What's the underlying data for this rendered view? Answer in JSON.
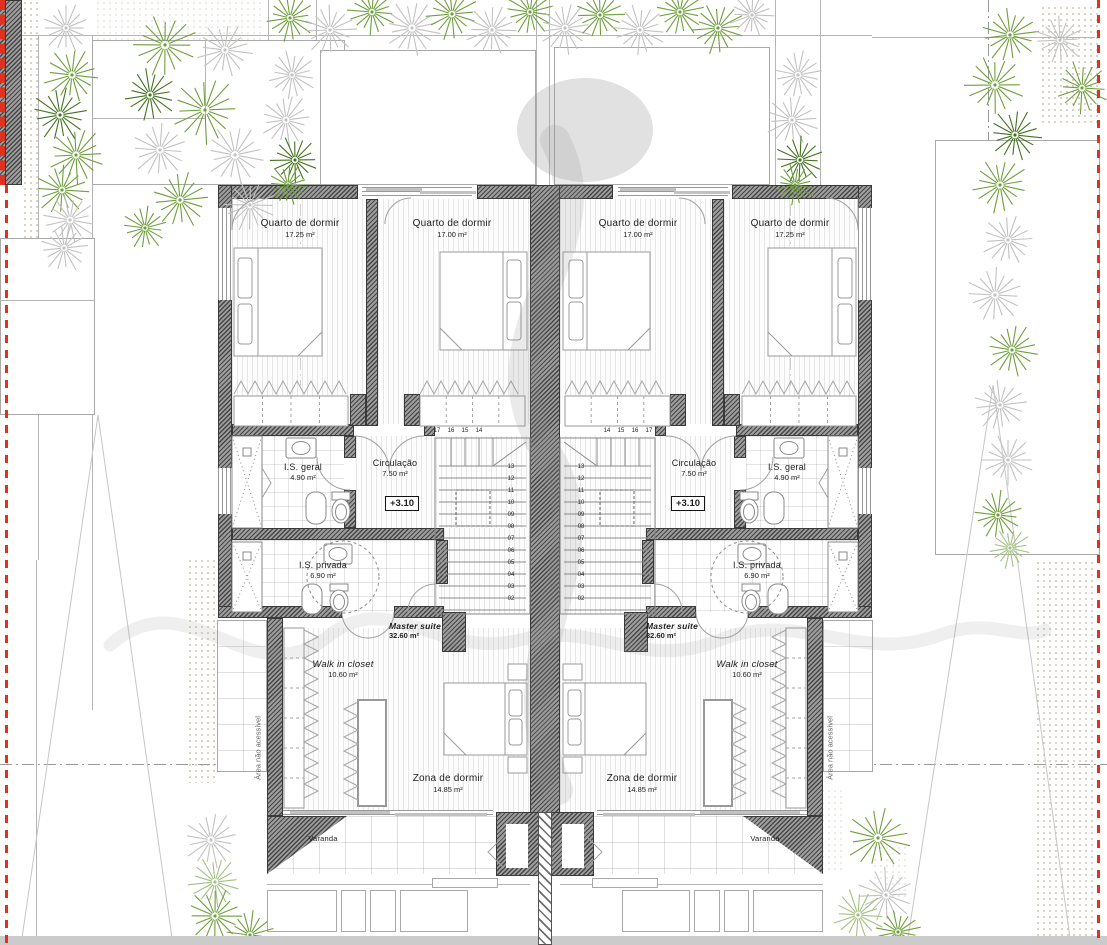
{
  "plan": {
    "rooms": {
      "quarto_outer": {
        "name": "Quarto de dormir",
        "area": "17.25 m²"
      },
      "quarto_inner": {
        "name": "Quarto de dormir",
        "area": "17.00 m²"
      },
      "is_geral": {
        "name": "I.S. geral",
        "area": "4.90 m²"
      },
      "circulacao": {
        "name": "Circulação",
        "area": "7.50 m²"
      },
      "is_privada": {
        "name": "I.S. privada",
        "area": "6.90 m²"
      },
      "master_suite": {
        "name": "Master suite",
        "area": "32.60 m²"
      },
      "walk_in_closet": {
        "name": "Walk in closet",
        "area": "10.60 m²"
      },
      "zona_de_dormir": {
        "name": "Zona de dormir",
        "area": "14.85 m²"
      },
      "varanda": {
        "name": "Varanda"
      }
    },
    "annotations": {
      "level": "+3.10",
      "area_nao_acessivel": "Área não acessível"
    },
    "stairs": {
      "top_numbers": [
        "17",
        "16",
        "15",
        "14"
      ],
      "side_numbers": [
        "13",
        "12",
        "11",
        "10",
        "09",
        "08",
        "07",
        "06",
        "05",
        "04",
        "03",
        "02"
      ]
    },
    "colors": {
      "wall_dark": "#3d3d3d",
      "plant_green": "#6f9e3c",
      "plant_dark": "#43721f",
      "plant_gray": "#c2c2c2",
      "plant_light": "#a4c184",
      "boundary_red": "#e03020"
    }
  }
}
